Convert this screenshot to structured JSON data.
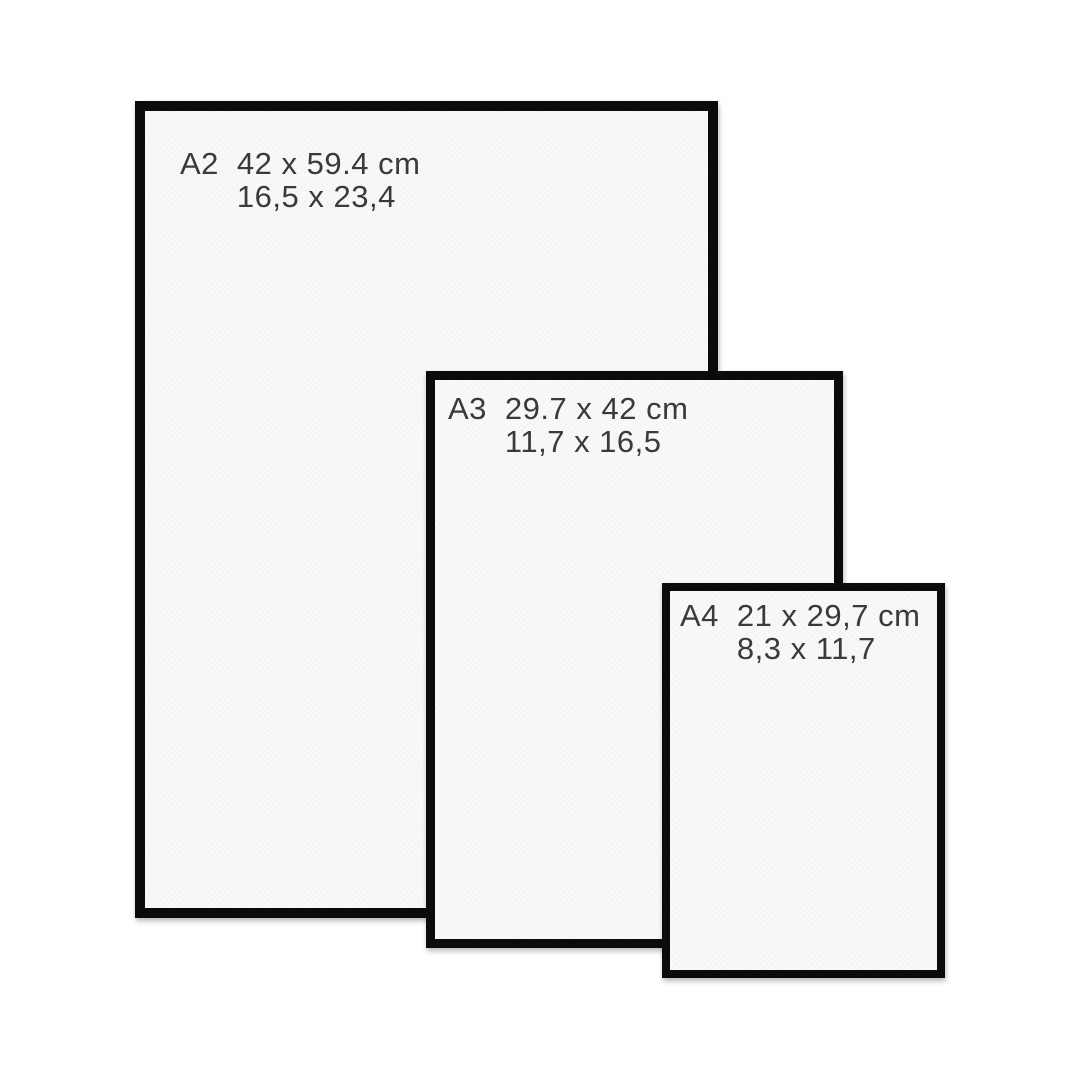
{
  "diagram": {
    "description": "Poster frame size comparison",
    "background_color": "#ffffff",
    "frame_border_color": "#0b0b0b",
    "paper_color": "#f9f9f8",
    "text_color": "#3a3a3a"
  },
  "frames": [
    {
      "label": "A2",
      "cm": "42 x 59.4 cm",
      "inches": "16,5 x 23,4"
    },
    {
      "label": "A3",
      "cm": "29.7 x 42 cm",
      "inches": "11,7 x 16,5"
    },
    {
      "label": "A4",
      "cm": "21 x 29,7 cm",
      "inches": "8,3 x 11,7"
    }
  ]
}
